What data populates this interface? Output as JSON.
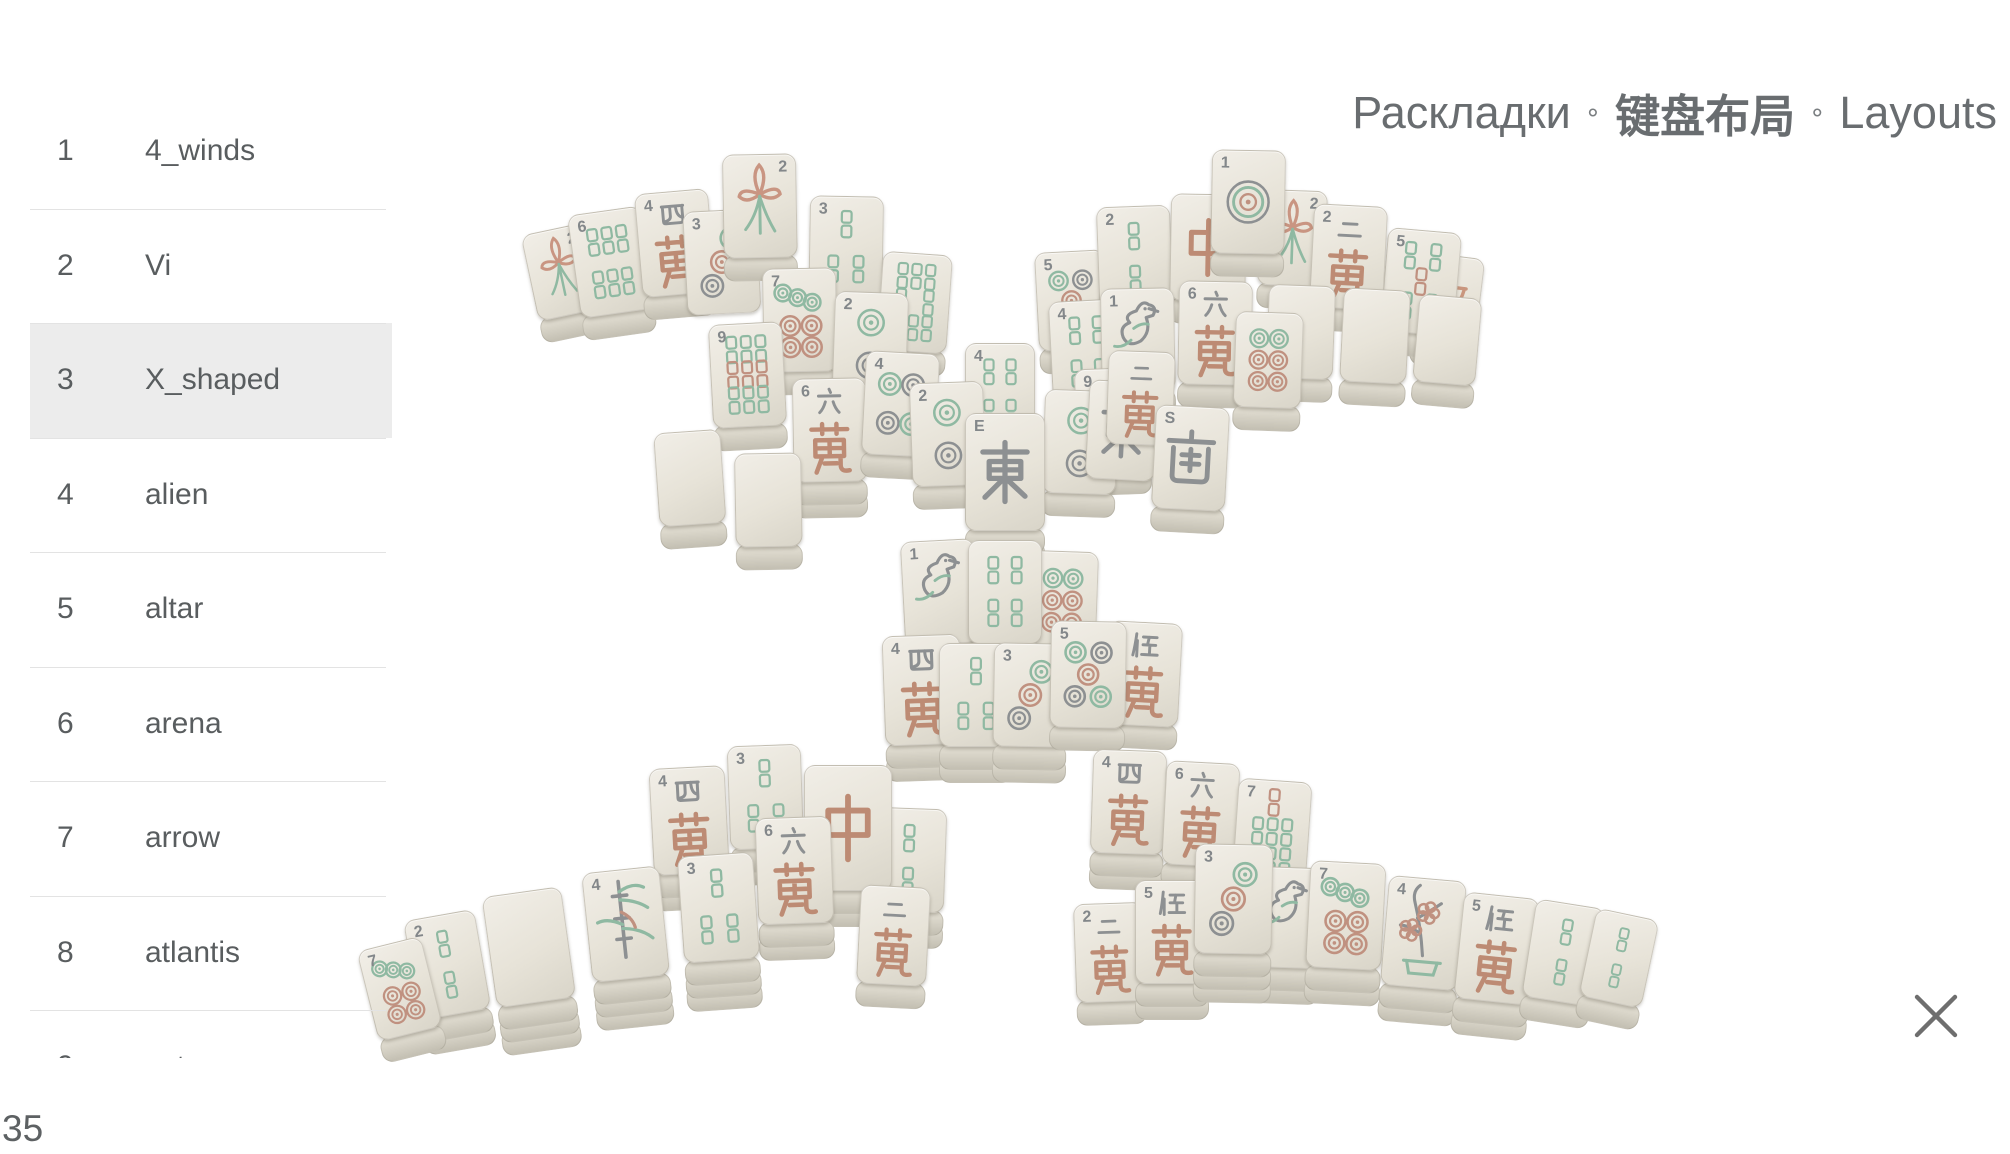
{
  "title": {
    "ru": "Раскладки",
    "zh": "键盘布局",
    "en": "Layouts",
    "separator": "∘"
  },
  "sidebar": {
    "items": [
      {
        "num": "1",
        "label": "4_winds",
        "selected": false
      },
      {
        "num": "2",
        "label": "Vi",
        "selected": false
      },
      {
        "num": "3",
        "label": "X_shaped",
        "selected": true
      },
      {
        "num": "4",
        "label": "alien",
        "selected": false
      },
      {
        "num": "5",
        "label": "altar",
        "selected": false
      },
      {
        "num": "6",
        "label": "arena",
        "selected": false
      },
      {
        "num": "7",
        "label": "arrow",
        "selected": false
      },
      {
        "num": "8",
        "label": "atlantis",
        "selected": false
      },
      {
        "num": "9",
        "label": "aztec",
        "selected": false
      }
    ]
  },
  "footer": {
    "count": "35"
  },
  "close": {
    "icon": "close-x"
  },
  "board": {
    "name": "X_shaped layout preview",
    "colors": {
      "tile_face": "#e9e5da",
      "tile_side": "#c9c5b8",
      "bamboo_green": "#8fb9a2",
      "dot_red": "#c09180",
      "glyph_gray": "#8d9092",
      "char_red": "#bd8b74"
    },
    "tile_fields": [
      "cx",
      "cy",
      "face",
      "corner",
      "rotation_deg",
      "stack",
      "w",
      "h"
    ],
    "face_names": {
      "blank": "blank tile",
      "b2": "2 bamboo",
      "b3": "3 bamboo",
      "b4": "4 bamboo",
      "b5": "5 bamboo",
      "b6": "6 bamboo",
      "b7": "7 bamboo",
      "b8": "8 bamboo",
      "b9": "9 bamboo",
      "d1": "1 dot",
      "d2": "2 dots",
      "d3": "3 dots",
      "d4": "4 dots",
      "d5": "5 dots",
      "d6": "6 dots",
      "d7": "7 dots",
      "w2": "2 characters 二萬",
      "w4": "4 characters 四萬",
      "w5": "5 characters 伍萬",
      "w6": "6 characters 六萬",
      "w9": "9 characters 九萬",
      "zhong": "red dragon 中",
      "dong": "east wind 東",
      "nan": "south wind 南",
      "lily": "flower lily",
      "plant": "flower bamboo plant",
      "plum": "season winter 冬 plum",
      "bird": "1 bamboo bird",
      "qiu": "season autumn 秋"
    },
    "tiles": [
      [
        562,
        272,
        "lily",
        "2",
        -12,
        1,
        63,
        88
      ],
      [
        612,
        262,
        "b6",
        "6",
        -8,
        1,
        74,
        104
      ],
      [
        676,
        243,
        "w4",
        "4",
        -5,
        1,
        74,
        104
      ],
      [
        722,
        262,
        "d3",
        "3",
        -3,
        0,
        74,
        104
      ],
      [
        760,
        206,
        "lily",
        "2",
        -1,
        1,
        74,
        104
      ],
      [
        846,
        248,
        "b3",
        "3",
        1,
        1,
        74,
        104
      ],
      [
        914,
        302,
        "b8",
        "",
        4,
        1,
        70,
        99
      ],
      [
        800,
        320,
        "d7",
        "7",
        -1,
        1,
        74,
        104
      ],
      [
        870,
        344,
        "d2",
        "2",
        2,
        1,
        74,
        104
      ],
      [
        748,
        375,
        "b9",
        "9",
        -3,
        1,
        74,
        104
      ],
      [
        830,
        430,
        "w6",
        "6",
        -1,
        2,
        74,
        104
      ],
      [
        900,
        404,
        "d4",
        "4",
        3,
        1,
        74,
        104
      ],
      [
        690,
        478,
        "blank",
        "",
        -4,
        1,
        67,
        94
      ],
      [
        768,
        500,
        "blank",
        "",
        -1,
        1,
        67,
        94
      ],
      [
        1072,
        300,
        "d5",
        "5",
        -3,
        1,
        70,
        99
      ],
      [
        1135,
        258,
        "b2",
        "2",
        -2,
        1,
        74,
        104
      ],
      [
        1447,
        300,
        "qiu",
        "",
        7,
        1,
        64,
        90
      ],
      [
        1420,
        282,
        "b5",
        "5",
        5,
        1,
        74,
        104
      ],
      [
        1292,
        238,
        "lily",
        "2",
        2,
        1,
        68,
        96
      ],
      [
        1348,
        257,
        "w2",
        "2",
        3,
        1,
        74,
        104
      ],
      [
        1208,
        247,
        "zhong",
        "",
        1,
        1,
        76,
        107
      ],
      [
        1248,
        202,
        "d1",
        "1",
        1,
        1,
        74,
        104
      ],
      [
        1300,
        332,
        "blank",
        "",
        2,
        1,
        67,
        94
      ],
      [
        1374,
        336,
        "blank",
        "",
        3,
        1,
        67,
        94
      ],
      [
        1446,
        340,
        "blank",
        "",
        5,
        1,
        63,
        88
      ],
      [
        1088,
        352,
        "b4",
        "4",
        -3,
        1,
        74,
        104
      ],
      [
        1138,
        340,
        "bird",
        "1",
        -1,
        1,
        74,
        104
      ],
      [
        1215,
        333,
        "w6",
        "6",
        1,
        1,
        74,
        104
      ],
      [
        1268,
        360,
        "d6",
        "",
        2,
        1,
        68,
        96
      ],
      [
        1113,
        420,
        "w9",
        "9",
        -2,
        1,
        74,
        104
      ],
      [
        1000,
        392,
        "b4",
        "4",
        0,
        0,
        70,
        99
      ],
      [
        948,
        434,
        "d2",
        "2",
        -2,
        1,
        74,
        104
      ],
      [
        1080,
        442,
        "d2",
        "",
        2,
        1,
        74,
        104
      ],
      [
        1122,
        430,
        "dong",
        "",
        3,
        0,
        70,
        99
      ],
      [
        1140,
        398,
        "w2",
        "",
        2,
        0,
        67,
        94
      ],
      [
        1190,
        458,
        "nan",
        "S",
        3,
        1,
        74,
        104
      ],
      [
        1005,
        472,
        "dong",
        "E",
        0,
        2,
        80,
        118
      ],
      [
        940,
        592,
        "bird",
        "1",
        -3,
        1,
        74,
        104
      ],
      [
        1062,
        600,
        "d6",
        "",
        2,
        1,
        70,
        99
      ],
      [
        1005,
        592,
        "b4",
        "",
        0,
        2,
        74,
        104
      ],
      [
        923,
        690,
        "w4",
        "4",
        -2,
        2,
        78,
        110
      ],
      [
        976,
        695,
        "b3",
        "",
        0,
        2,
        74,
        104
      ],
      [
        1030,
        695,
        "d3",
        "3",
        1,
        2,
        74,
        104
      ],
      [
        1143,
        674,
        "w5",
        "",
        3,
        1,
        74,
        104
      ],
      [
        1088,
        674,
        "d5",
        "5",
        1,
        1,
        76,
        107
      ],
      [
        690,
        820,
        "w4",
        "4",
        -3,
        2,
        76,
        107
      ],
      [
        766,
        797,
        "b3",
        "3",
        -2,
        2,
        74,
        104
      ],
      [
        908,
        860,
        "b2",
        "",
        2,
        2,
        74,
        104
      ],
      [
        848,
        828,
        "zhong",
        "",
        0,
        2,
        88,
        126
      ],
      [
        893,
        935,
        "w2",
        "",
        3,
        1,
        70,
        99
      ],
      [
        795,
        870,
        "w6",
        "6",
        -2,
        2,
        76,
        107
      ],
      [
        720,
        907,
        "b3",
        "3",
        -4,
        3,
        76,
        107
      ],
      [
        628,
        924,
        "plant",
        "4",
        -6,
        3,
        78,
        110
      ],
      [
        532,
        947,
        "blank",
        "",
        -8,
        3,
        80,
        112
      ],
      [
        450,
        964,
        "b2",
        "2",
        -10,
        2,
        72,
        101
      ],
      [
        402,
        988,
        "d7",
        "7",
        -14,
        1,
        66,
        93
      ],
      [
        1128,
        802,
        "w4",
        "4",
        2,
        2,
        74,
        104
      ],
      [
        1200,
        814,
        "w6",
        "6",
        3,
        2,
        74,
        104
      ],
      [
        1271,
        832,
        "b7",
        "7",
        4,
        2,
        74,
        104
      ],
      [
        1110,
        952,
        "w2",
        "2",
        -2,
        1,
        70,
        99
      ],
      [
        1172,
        932,
        "w5",
        "5",
        0,
        2,
        74,
        104
      ],
      [
        1285,
        917,
        "bird",
        "1",
        2,
        2,
        72,
        101
      ],
      [
        1345,
        915,
        "d7",
        "7",
        3,
        2,
        76,
        107
      ],
      [
        1233,
        899,
        "d3",
        "3",
        1,
        3,
        78,
        110
      ],
      [
        1422,
        933,
        "plum",
        "4",
        5,
        2,
        78,
        110
      ],
      [
        1495,
        948,
        "w5",
        "5",
        6,
        2,
        76,
        107
      ],
      [
        1562,
        952,
        "b2",
        "",
        9,
        1,
        70,
        99
      ],
      [
        1617,
        958,
        "b2",
        "",
        12,
        1,
        64,
        90
      ]
    ]
  }
}
